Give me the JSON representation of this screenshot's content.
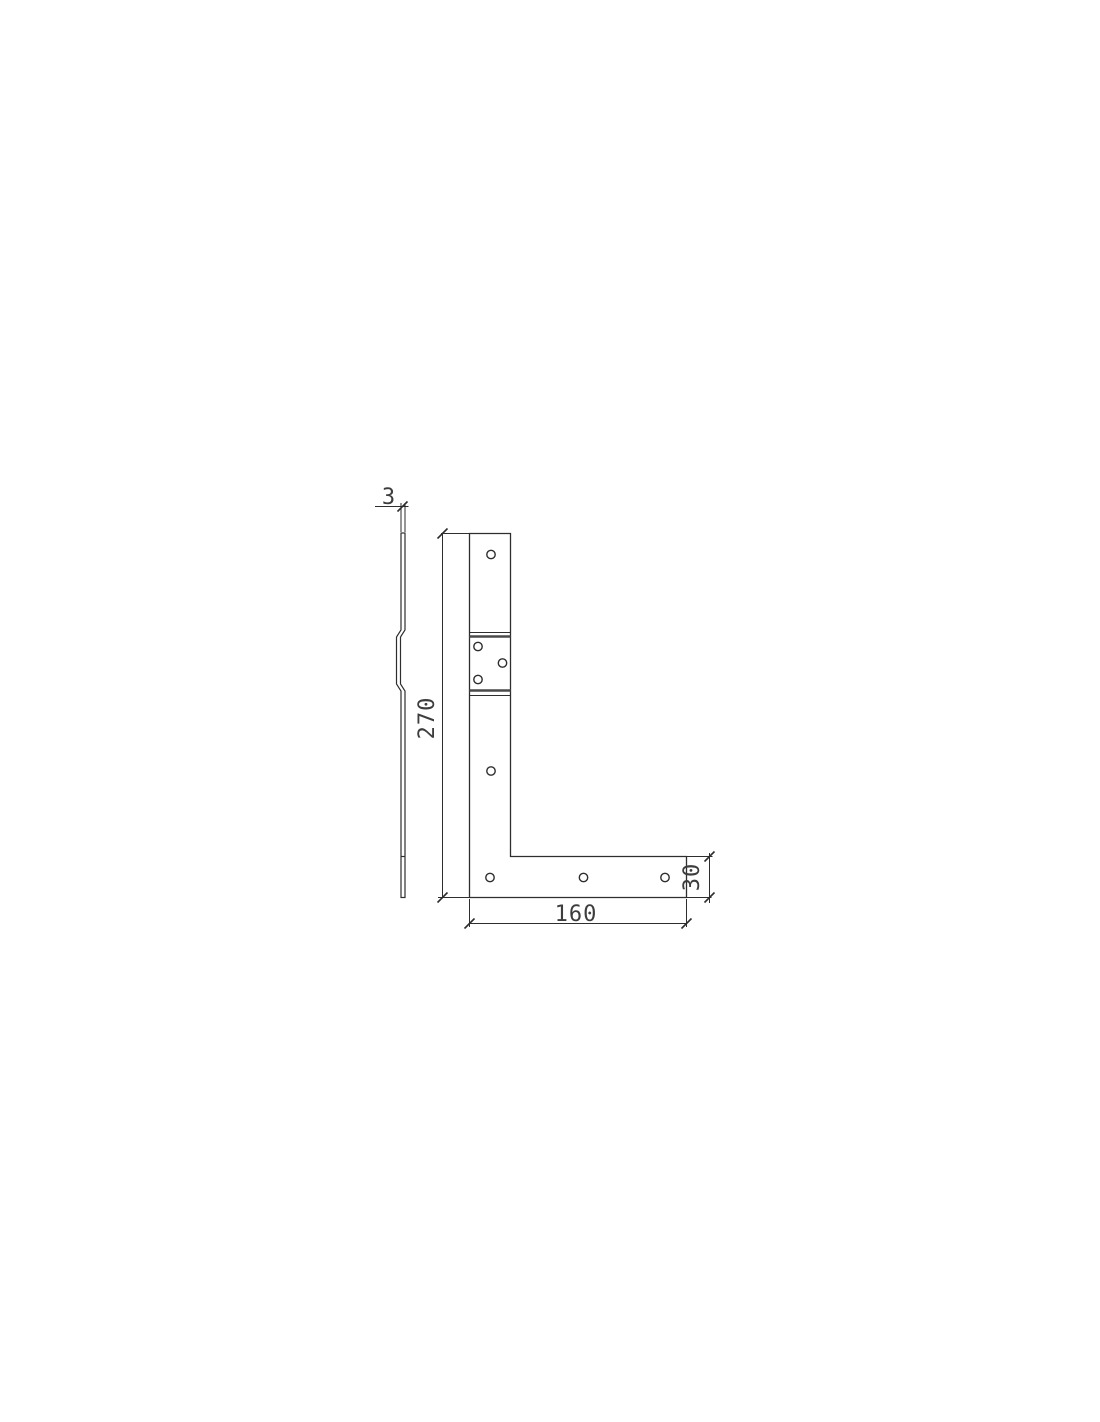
{
  "canvas": {
    "background": "#ffffff",
    "line_color": "#2e2e2e",
    "band_line_color": "#4a4a4a",
    "text_color": "#3d3d3d"
  },
  "drawing": {
    "type": "2D technical drawing, orthographic views",
    "part": "L-shaped flat corner bracket with joggled offset section",
    "views": [
      {
        "id": "side-profile",
        "description": "thin edge-on profile with joggle offset bend",
        "hole_count": 0
      },
      {
        "id": "front",
        "description": "L-shaped plate outline with joggle band and round holes",
        "hole_count": 8
      }
    ],
    "holes": {
      "vertical_leg": 2,
      "joggle_section": 3,
      "bottom_leg": 3
    }
  },
  "dims": {
    "thickness": "3",
    "height": "270",
    "width": "160",
    "leg": "30"
  }
}
